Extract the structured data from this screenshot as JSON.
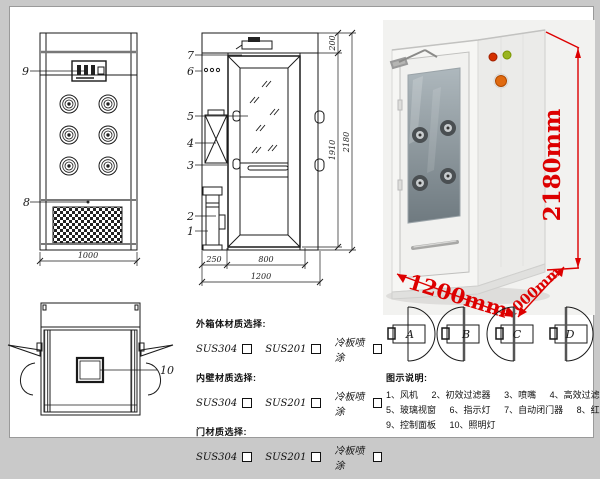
{
  "front_view": {
    "label_9": "9",
    "label_8": "8",
    "dim_width": "1000"
  },
  "side_view": {
    "label_1": "1",
    "label_2": "2",
    "label_3": "3",
    "label_4": "4",
    "label_5": "5",
    "label_6": "6",
    "label_7": "7",
    "dim_top": "200",
    "dim_door_height": "1910",
    "dim_total_height": "2180",
    "dim_side": "250",
    "dim_door_width": "800",
    "dim_total_width": "1200"
  },
  "top_view": {
    "label_10": "10"
  },
  "photo": {
    "dim_height": "2180mm",
    "dim_width": "1200mm",
    "dim_depth": "1000mm",
    "dim_color": "#dd0000"
  },
  "materials": {
    "sections": [
      {
        "title": "外箱体材质选择:",
        "options": [
          "SUS304",
          "SUS201",
          "冷板喷涂"
        ]
      },
      {
        "title": "内壁材质选择:",
        "options": [
          "SUS304",
          "SUS201",
          "冷板喷涂"
        ]
      },
      {
        "title": "门材质选择:",
        "options": [
          "SUS304",
          "SUS201",
          "冷板喷涂"
        ]
      }
    ]
  },
  "door_options": {
    "labels": [
      "A",
      "B",
      "C",
      "D"
    ]
  },
  "legend": {
    "title": "图示说明:",
    "items": [
      "1、风机",
      "2、初效过滤器",
      "3、喷嘴",
      "4、高效过滤器",
      "5、玻璃视窗",
      "6、指示灯",
      "7、自动闭门器",
      "8、红外线感应器",
      "9、控制面板",
      "10、照明灯"
    ]
  }
}
